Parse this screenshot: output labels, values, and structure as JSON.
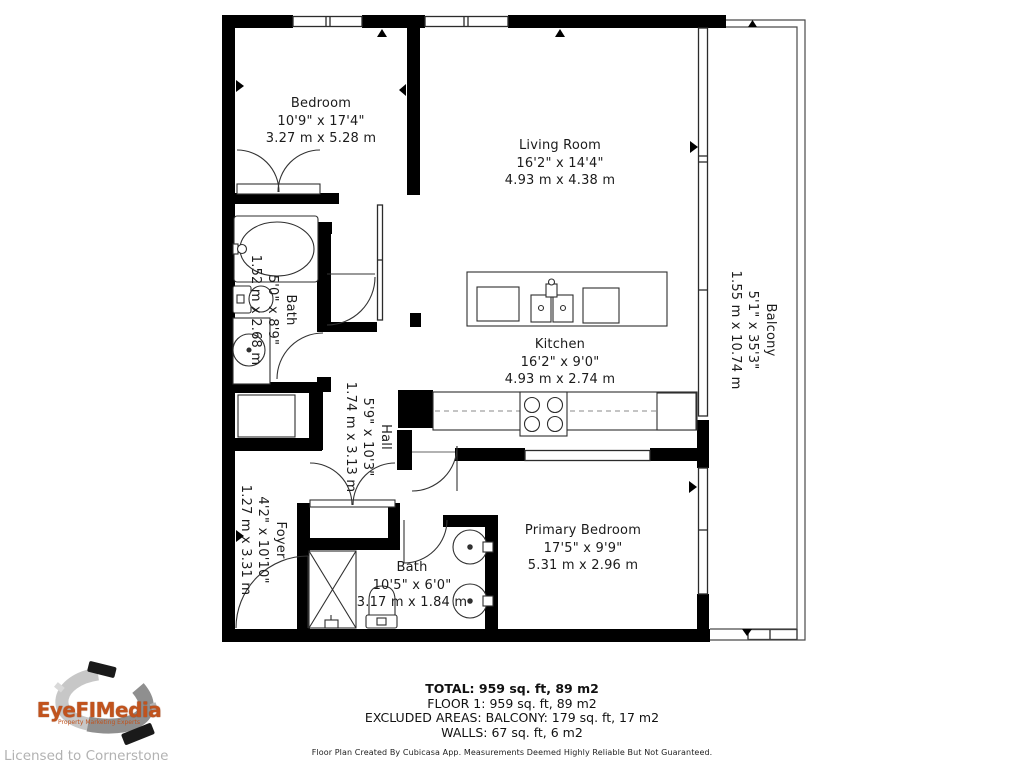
{
  "branding": {
    "logo_text": "EyeFIMedia",
    "logo_tagline": "Property Marketing Experts",
    "license_text": "Licensed to Cornerstone",
    "logo_color": "#c1531d"
  },
  "rooms": {
    "bedroom": {
      "name": "Bedroom",
      "imperial": "10'9\" x 17'4\"",
      "metric": "3.27 m x 5.28 m"
    },
    "living_room": {
      "name": "Living Room",
      "imperial": "16'2\" x 14'4\"",
      "metric": "4.93 m x 4.38 m"
    },
    "kitchen": {
      "name": "Kitchen",
      "imperial": "16'2\" x 9'0\"",
      "metric": "4.93 m x 2.74 m"
    },
    "bath": {
      "name": "Bath",
      "imperial": "5'0\" x 8'9\"",
      "metric": "1.52 m x 2.68 m"
    },
    "hall": {
      "name": "Hall",
      "imperial": "5'9\" x 10'3\"",
      "metric": "1.74 m x 3.13 m"
    },
    "foyer": {
      "name": "Foyer",
      "imperial": "4'2\" x 10'10\"",
      "metric": "1.27 m x 3.31 m"
    },
    "balcony": {
      "name": "Balcony",
      "imperial": "5'1\" x 35'3\"",
      "metric": "1.55 m x 10.74 m"
    },
    "primary_bedroom": {
      "name": "Primary Bedroom",
      "imperial": "17'5\" x 9'9\"",
      "metric": "5.31 m x 2.96 m"
    },
    "bath2": {
      "name": "Bath",
      "imperial": "10'5\" x 6'0\"",
      "metric": "3.17 m x 1.84 m"
    }
  },
  "summary": {
    "total": "TOTAL: 959 sq. ft, 89 m2",
    "floor": "FLOOR 1: 959 sq. ft, 89 m2",
    "excluded": "EXCLUDED AREAS: BALCONY: 179 sq. ft, 17 m2",
    "walls": "WALLS: 67 sq. ft, 6 m2",
    "disclaimer": "Floor Plan Created By Cubicasa App. Measurements Deemed Highly Reliable But Not Guaranteed."
  }
}
